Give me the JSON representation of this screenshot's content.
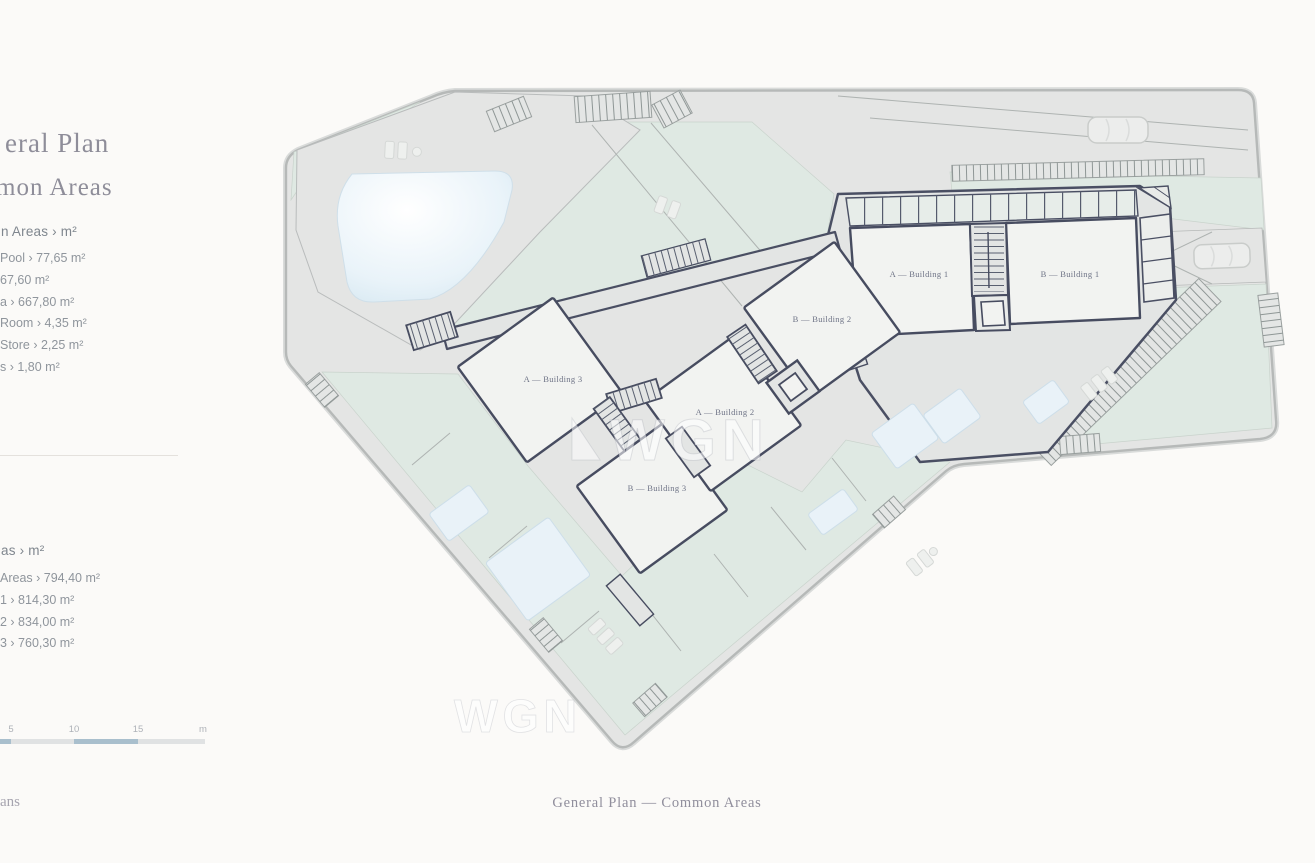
{
  "sidebar": {
    "title_line1": "eral Plan",
    "title_line2": "mon Areas",
    "list1": {
      "header": "n Areas › m²",
      "items": [
        "Pool › 77,65 m²",
        "67,60 m²",
        "a › 667,80 m²",
        "Room › 4,35 m²",
        "Store › 2,25 m²",
        "s › 1,80 m²"
      ]
    },
    "list2": {
      "header": "as › m²",
      "items": [
        "Areas › 794,40 m²",
        "1 › 814,30 m²",
        "2 › 834,00 m²",
        "3 › 760,30 m²"
      ]
    },
    "scale": {
      "labels": [
        "5",
        "10",
        "15",
        "m"
      ]
    },
    "footer_fragment": "ans"
  },
  "plan": {
    "buildings": [
      {
        "label": "A — Building 3"
      },
      {
        "label": "B — Building 3"
      },
      {
        "label": "A — Building 2"
      },
      {
        "label": "B — Building 2"
      },
      {
        "label": "A — Building 1"
      },
      {
        "label": "B — Building 1"
      }
    ],
    "watermark": "WGN"
  },
  "caption": "General Plan — Common Areas",
  "colors": {
    "scale_accent": "#a9bfcd",
    "green_area": "#dfe9e3",
    "road": "#e4e5e4",
    "building_outline": "#4a4f63",
    "pool": "#dcebf3"
  }
}
